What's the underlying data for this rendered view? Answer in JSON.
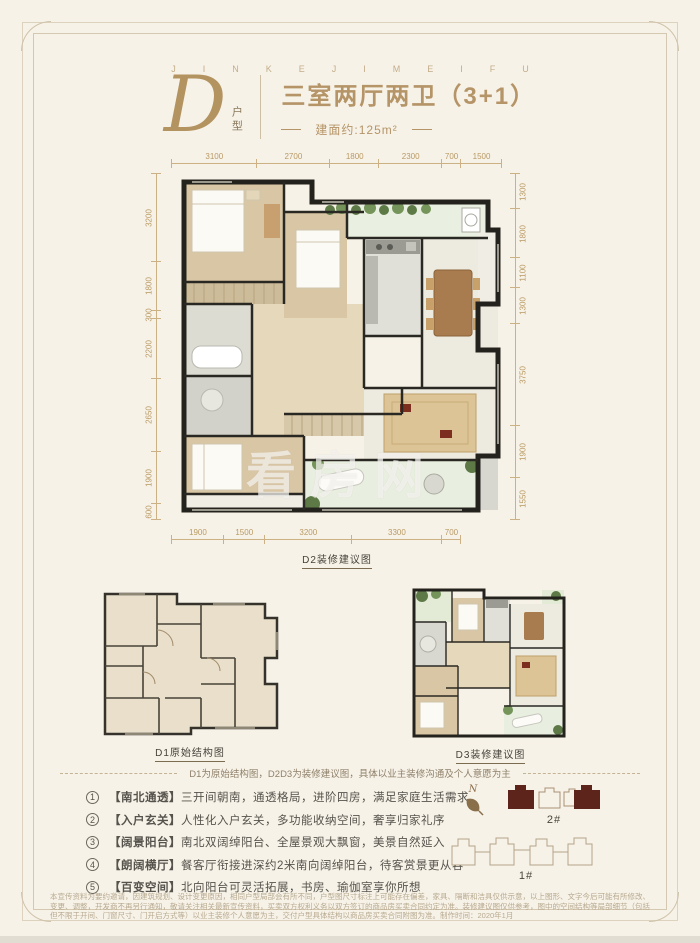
{
  "brand": {
    "letters": "JINKEJIMEIFU"
  },
  "logo": {
    "letter": "D",
    "label": "户型"
  },
  "header": {
    "title": "三室两厅两卫（3+1）",
    "area": "建面约:125m²"
  },
  "plan_main": {
    "caption": "D2装修建议图",
    "watermark": "看房网",
    "dims": {
      "top": [
        "3100",
        "2700",
        "1800",
        "2300",
        "700",
        "1500"
      ],
      "left": [
        "3200",
        "1800",
        "300",
        "2200",
        "2650",
        "1900",
        "600"
      ],
      "right": [
        "1300",
        "1800",
        "1100",
        "1300",
        "3750",
        "1900",
        "1550"
      ],
      "bottom": [
        "1900",
        "1500",
        "3200",
        "3300",
        "700"
      ]
    }
  },
  "plan_d1": {
    "caption": "D1原始结构图"
  },
  "plan_d3": {
    "caption": "D3装修建议图"
  },
  "note": {
    "text": "D1为原始结构图，D2D3为装修建议图，具体以业主装修沟通及个人意愿为主"
  },
  "features": [
    {
      "num": "1",
      "tag": "【南北通透】",
      "text": "三开间朝南，通透格局，进阶四房，满足家庭生活需求"
    },
    {
      "num": "2",
      "tag": "【入户玄关】",
      "text": "人性化入户玄关，多功能收纳空间，奢享归家礼序"
    },
    {
      "num": "3",
      "tag": "【阔景阳台】",
      "text": "南北双阔绰阳台、全屋景观大飘窗，美景自然延入"
    },
    {
      "num": "4",
      "tag": "【朗阔横厅】",
      "text": "餐客厅衔接进深约2米南向阔绰阳台，待客赏景更从容"
    },
    {
      "num": "5",
      "tag": "【百变空间】",
      "text": "北向阳台可灵活拓展，书房、瑜伽室享你所想"
    }
  ],
  "siteplan": {
    "compass_label": "N",
    "building2_label": "2#",
    "building1_label": "1#"
  },
  "disclaimer": {
    "line1": "本宣传资料为要约邀请，因建筑规划、设计变更原因，相同户型局部会有所不同，户型图尺寸标注上可能存在偏差，家具、隔断和洁具仅供示意，以上图形、文字今后可能有所修改、变更、调整，",
    "line2": "开发商不再另行通知，敬请关注相关最新宣传资料，买卖双方权利义务以双方签订的商品房买卖合同约定为准。装修建议图仅供参考，图中的空间结构等局部细节（包括但不限于开间、门窗尺寸、",
    "line3": "门开启方式等）以业主装修个人意愿为主，交付户型具体结构以商品房买卖合同附图为准。制作时间：2020年1月"
  },
  "colors": {
    "gold": "#b3935f",
    "dim_line": "#cbb183",
    "wall": "#24221d",
    "maroon": "#5d241c",
    "background": "#f7f2e8"
  }
}
